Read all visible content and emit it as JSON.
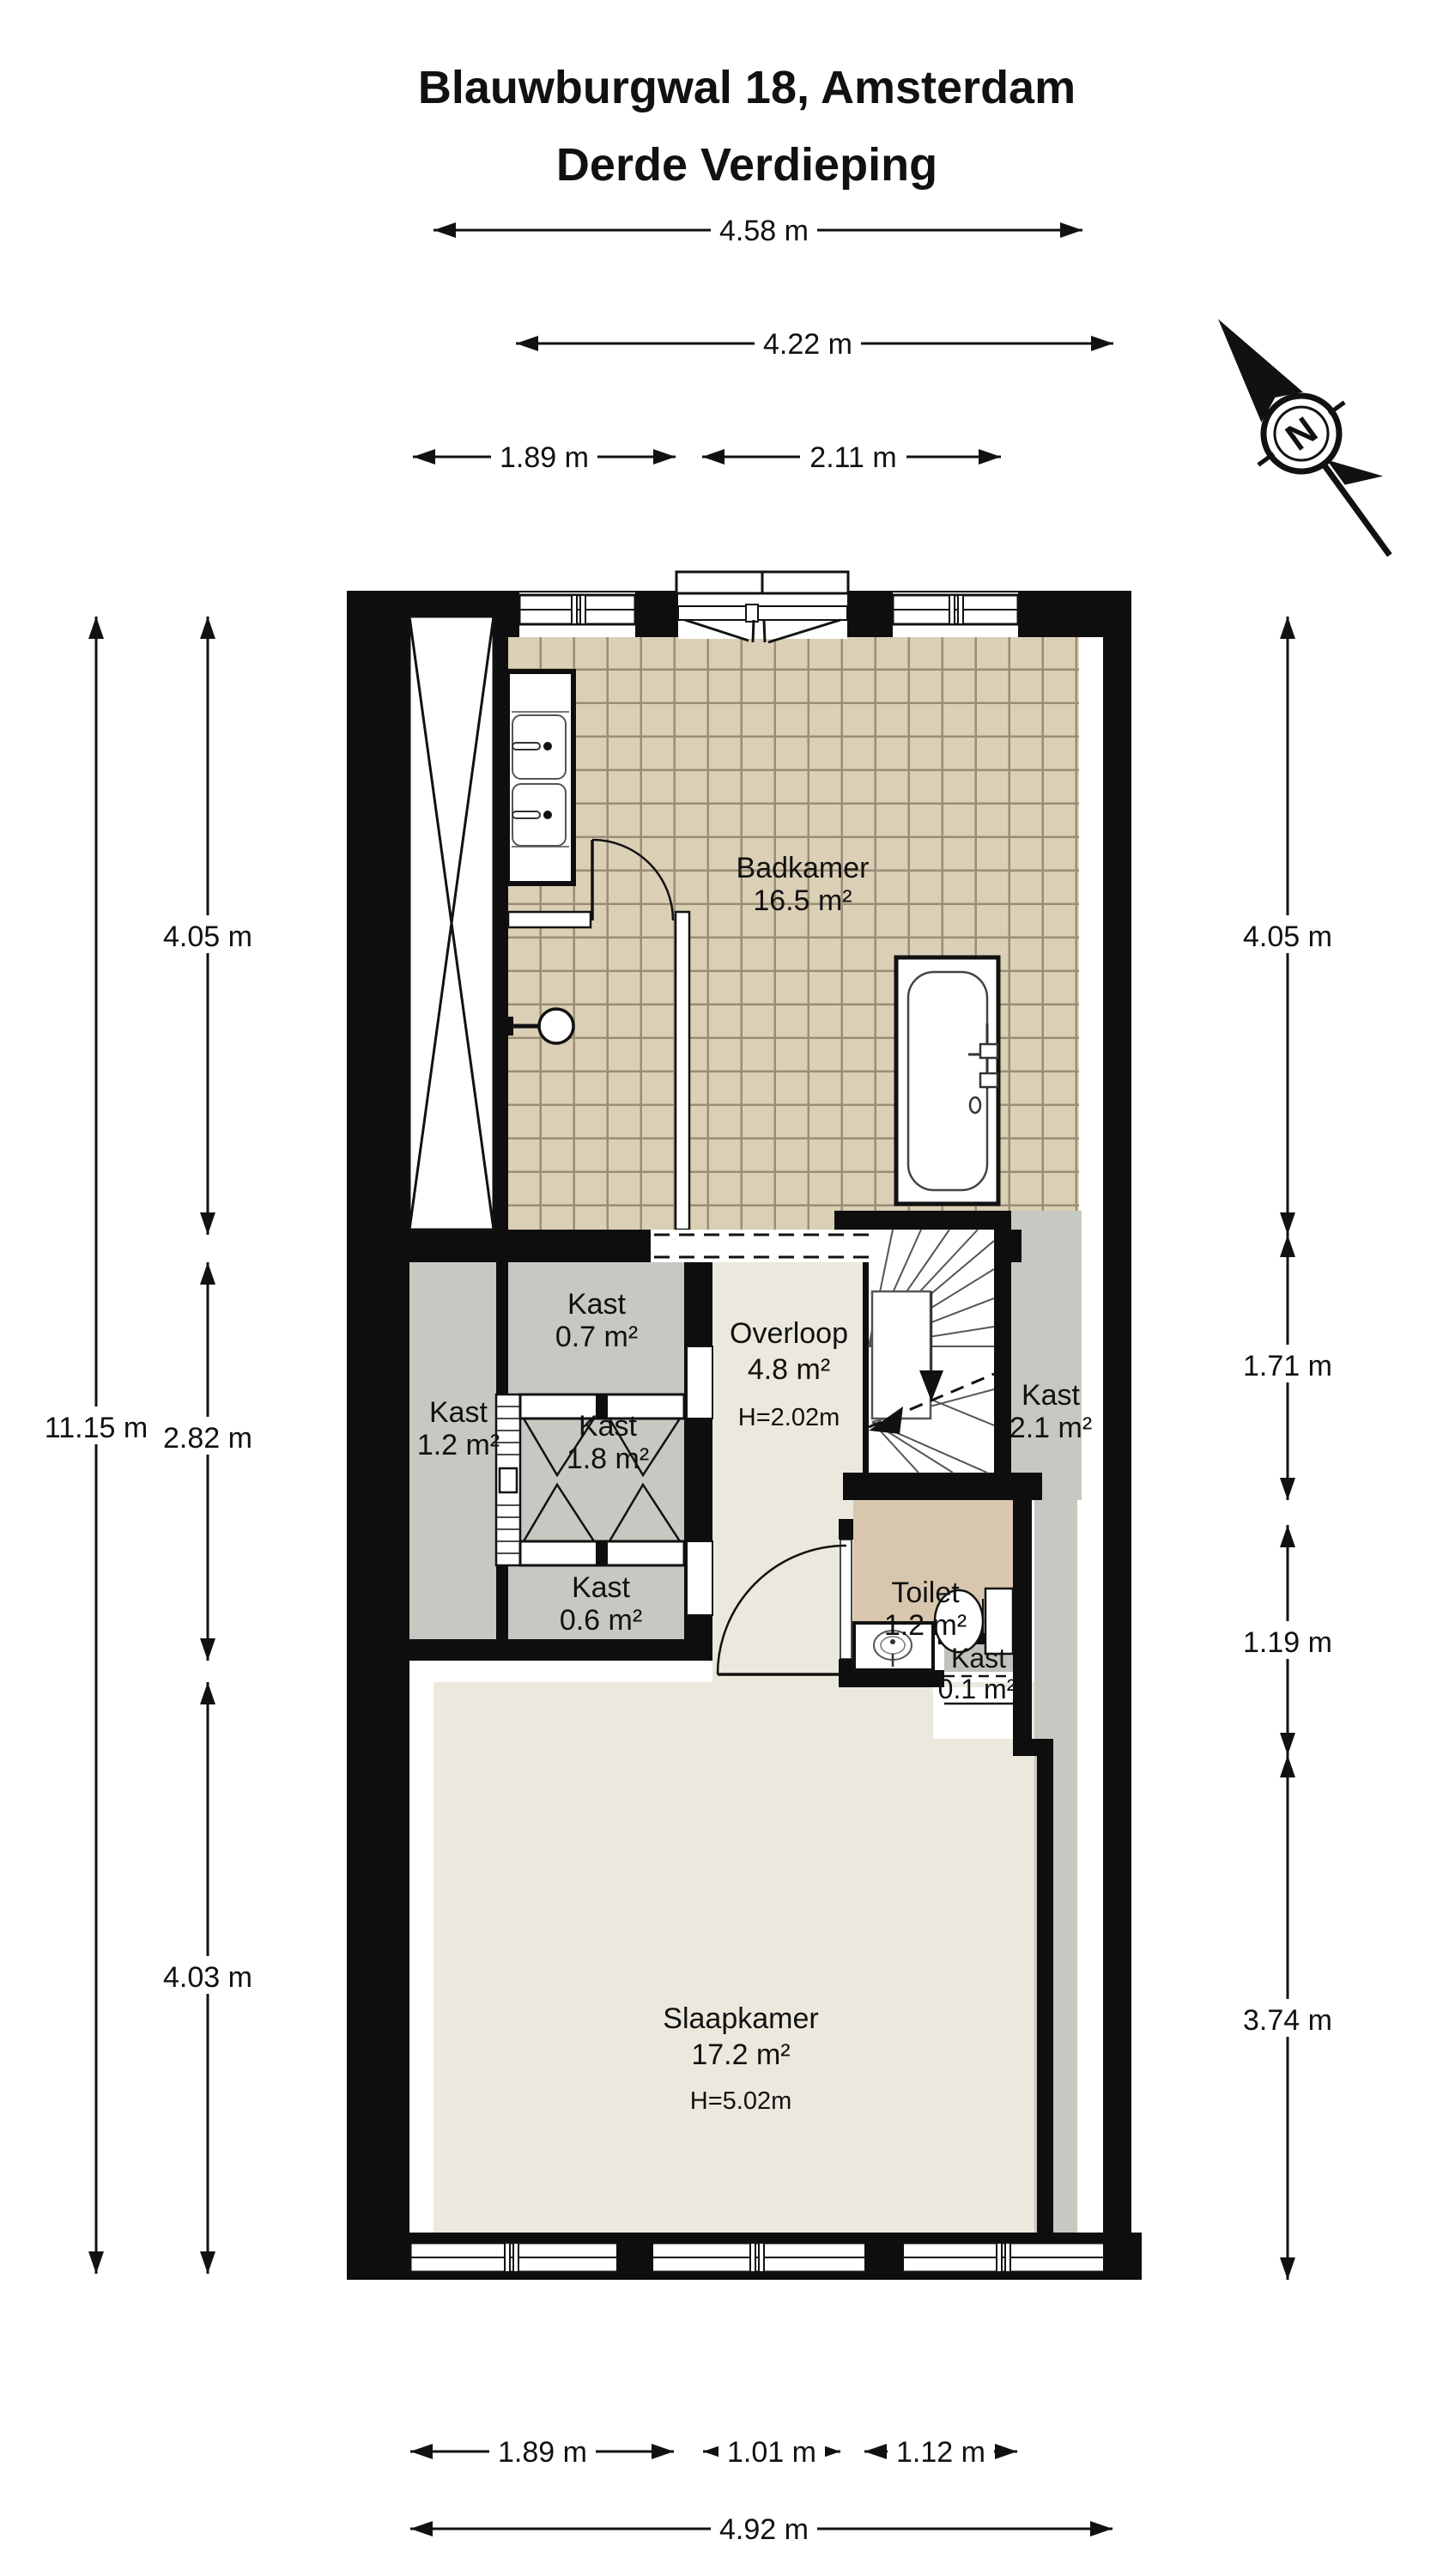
{
  "title": {
    "line1": "Blauwburgwal 18, Amsterdam",
    "line2": "Derde Verdieping"
  },
  "compass": {
    "label": "N"
  },
  "rooms": {
    "badkamer": {
      "name": "Badkamer",
      "area": "16.5 m²"
    },
    "kast07": {
      "name": "Kast",
      "area": "0.7 m²"
    },
    "overloop": {
      "name": "Overloop",
      "area": "4.8 m²",
      "height": "H=2.02m"
    },
    "kast12": {
      "name": "Kast",
      "area": "1.2 m²"
    },
    "kast18": {
      "name": "Kast",
      "area": "1.8 m²"
    },
    "kast21": {
      "name": "Kast",
      "area": "2.1 m²"
    },
    "kast06": {
      "name": "Kast",
      "area": "0.6 m²"
    },
    "toilet": {
      "name": "Toilet",
      "area": "1.2 m²"
    },
    "kast01": {
      "name": "Kast",
      "area": "0.1 m²"
    },
    "slaapkamer": {
      "name": "Slaapkamer",
      "area": "17.2 m²",
      "height": "H=5.02m"
    }
  },
  "dimensions": {
    "top": {
      "d1": "4.58 m",
      "d2": "4.22 m",
      "d3": "1.89 m",
      "d4": "2.11 m"
    },
    "bottom": {
      "d1": "1.89 m",
      "d2": "1.01 m",
      "d3": "1.12 m",
      "d4": "4.92 m"
    },
    "left": {
      "d1": "4.05 m",
      "d2": "11.15 m",
      "d3": "2.82 m",
      "d4": "4.03 m"
    },
    "right": {
      "d1": "4.05 m",
      "d2": "1.71 m",
      "d3": "1.19 m",
      "d4": "3.74 m"
    }
  },
  "colors": {
    "wall": "#0e0e0e",
    "tile_fill": "#dbcfb6",
    "tile_grout": "#9a8e76",
    "closet_gray": "#c6c9c1",
    "hall_cream": "#ebe8dd",
    "toilet_tan": "#d8c7ae",
    "background": "#ffffff"
  }
}
